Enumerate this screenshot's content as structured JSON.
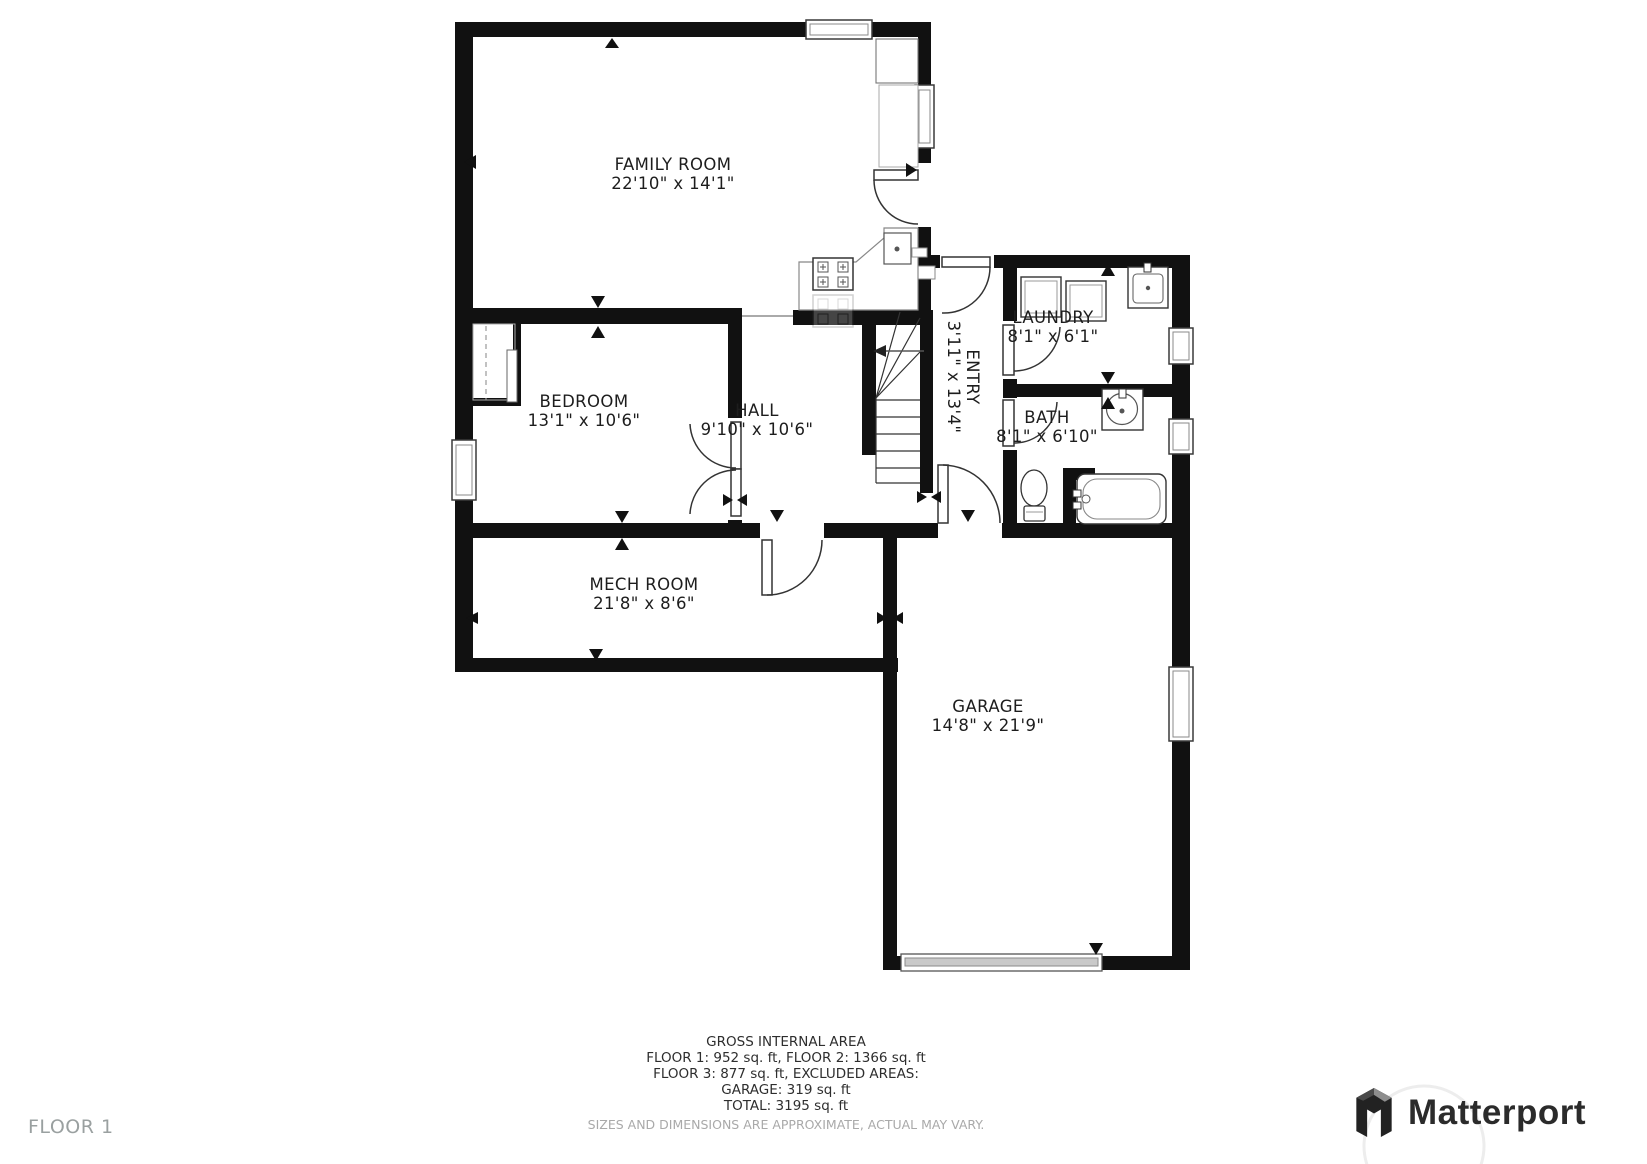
{
  "plan": {
    "floor_label": "FLOOR 1",
    "rooms": [
      {
        "name": "FAMILY ROOM",
        "dims": "22'10\" x 14'1\""
      },
      {
        "name": "BEDROOM",
        "dims": "13'1\" x 10'6\""
      },
      {
        "name": "HALL",
        "dims": "9'10\" x 10'6\""
      },
      {
        "name": "ENTRY",
        "dims": "3'11\" x 13'4\""
      },
      {
        "name": "LAUNDRY",
        "dims": "8'1\" x 6'1\""
      },
      {
        "name": "BATH",
        "dims": "8'1\" x 6'10\""
      },
      {
        "name": "MECH ROOM",
        "dims": "21'8\" x 8'6\""
      },
      {
        "name": "GARAGE",
        "dims": "14'8\" x 21'9\""
      }
    ]
  },
  "footer": {
    "lines": [
      "GROSS INTERNAL AREA",
      "FLOOR 1: 952 sq. ft, FLOOR 2: 1366 sq. ft",
      "FLOOR 3: 877 sq. ft, EXCLUDED AREAS:",
      "GARAGE: 319 sq. ft",
      "TOTAL: 3195 sq. ft"
    ],
    "disclaimer": "SIZES AND DIMENSIONS ARE APPROXIMATE, ACTUAL MAY VARY."
  },
  "branding": {
    "logo_text": "Matterport"
  },
  "colors": {
    "wall": "#111111",
    "label": "#1d1d1d",
    "muted": "#9aa0a0",
    "fixture": "#444444"
  }
}
